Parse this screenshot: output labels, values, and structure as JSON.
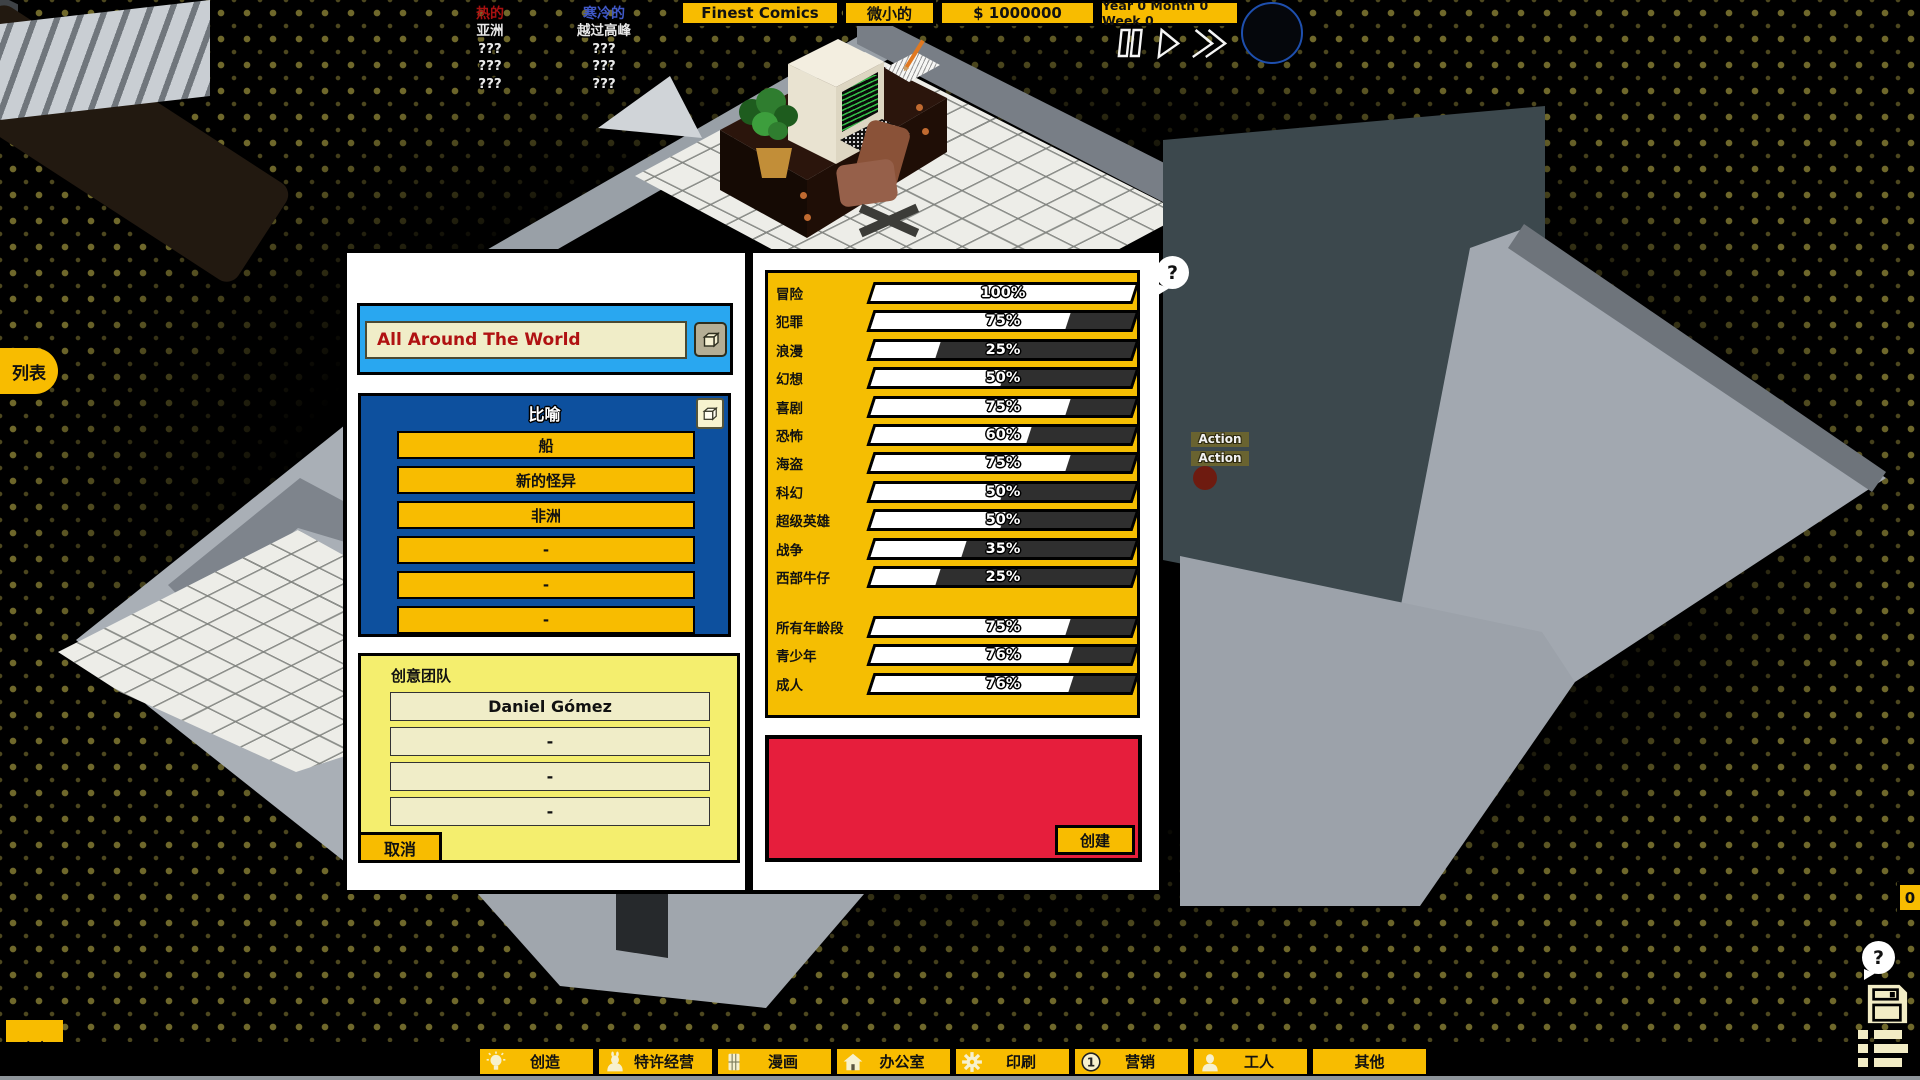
{
  "colors": {
    "ui_yellow": "#F8BC00",
    "hot_red": "#A81111",
    "cold_blue": "#4059C8",
    "panel_blue": "#29A7F0",
    "panel_dark_blue": "#0D509E",
    "panel_light_yellow": "#F4EE6E",
    "cream": "#F0EDC8",
    "red_panel": "#E61E3C",
    "slider_dark": "#2F2F2F",
    "title_text_red": "#B01212"
  },
  "top_bar": {
    "trends": {
      "hot": {
        "label": "热的",
        "items": [
          "亚洲",
          "???",
          "???",
          "???"
        ]
      },
      "cold": {
        "label": "寒冷的",
        "items": [
          "越过高峰",
          "???",
          "???",
          "???"
        ]
      }
    },
    "company_tab": "Finest Comics",
    "size_tab": "微小的",
    "money_tab": "$ 1000000",
    "date_tab": "Year 0 Month 0 Week 0",
    "controls": [
      "pause-icon",
      "play-icon",
      "fast-forward-icon"
    ]
  },
  "left_edge": {
    "list_button": "列表",
    "build_button": "建立"
  },
  "dialog": {
    "title_input": {
      "value": "All Around The World"
    },
    "tropes": {
      "title": "比喻",
      "options": [
        "船",
        "新的怪异",
        "非洲",
        "-",
        "-",
        "-"
      ]
    },
    "team": {
      "title": "创意团队",
      "members": [
        "Daniel Gómez",
        "-",
        "-",
        "-"
      ],
      "cancel_label": "取消"
    },
    "genres": [
      {
        "label": "冒险",
        "pct": "100%",
        "value": 100
      },
      {
        "label": "犯罪",
        "pct": "75%",
        "value": 75
      },
      {
        "label": "浪漫",
        "pct": "25%",
        "value": 25
      },
      {
        "label": "幻想",
        "pct": "50%",
        "value": 50
      },
      {
        "label": "喜剧",
        "pct": "75%",
        "value": 75
      },
      {
        "label": "恐怖",
        "pct": "60%",
        "value": 60
      },
      {
        "label": "海盗",
        "pct": "75%",
        "value": 75
      },
      {
        "label": "科幻",
        "pct": "50%",
        "value": 50
      },
      {
        "label": "超级英雄",
        "pct": "50%",
        "value": 50
      },
      {
        "label": "战争",
        "pct": "35%",
        "value": 35
      },
      {
        "label": "西部牛仔",
        "pct": "25%",
        "value": 25
      }
    ],
    "ages": [
      {
        "label": "所有年龄段",
        "pct": "75%",
        "value": 75
      },
      {
        "label": "青少年",
        "pct": "76%",
        "value": 76
      },
      {
        "label": "成人",
        "pct": "76%",
        "value": 76
      }
    ],
    "create_label": "创建"
  },
  "scene": {
    "action_labels": [
      "Action",
      "Action"
    ],
    "help_bubble": "?"
  },
  "right_edge": {
    "counter": "0",
    "help_bubble": "?"
  },
  "bottom_bar": {
    "tabs": [
      {
        "label": "创造",
        "icon": "lightbulb-icon"
      },
      {
        "label": "特许经营",
        "icon": "mascot-icon"
      },
      {
        "label": "漫画",
        "icon": "comic-page-icon"
      },
      {
        "label": "办公室",
        "icon": "house-icon"
      },
      {
        "label": "印刷",
        "icon": "gear-icon"
      },
      {
        "label": "营销",
        "icon": "coin-icon"
      },
      {
        "label": "工人",
        "icon": "worker-icon"
      },
      {
        "label": "其他",
        "icon": ""
      }
    ]
  }
}
